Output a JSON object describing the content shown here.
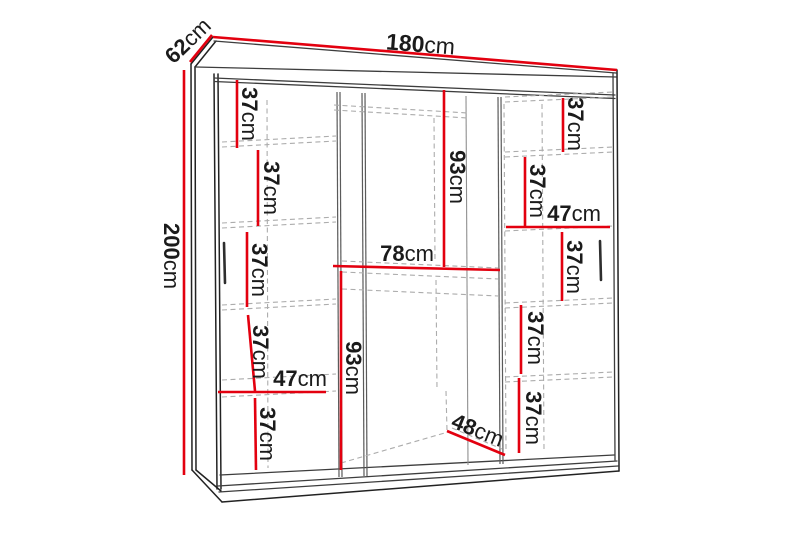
{
  "diagram": {
    "type": "furniture-dimension-drawing",
    "subject": "three-door sliding wardrobe wireframe with internal shelf measurements",
    "unit": "cm",
    "accent_color": "#e3000f",
    "line_color": "#1b1b1b",
    "hidden_line_color": "#acacac",
    "background": "#ffffff"
  },
  "overall": {
    "width": {
      "v": "180",
      "u": "cm"
    },
    "depth": {
      "v": "62",
      "u": "cm"
    },
    "height": {
      "v": "200",
      "u": "cm"
    }
  },
  "left_column": {
    "shelf1": {
      "v": "37",
      "u": "cm"
    },
    "shelf2": {
      "v": "37",
      "u": "cm"
    },
    "shelf3": {
      "v": "37",
      "u": "cm"
    },
    "shelf4": {
      "v": "37",
      "u": "cm"
    },
    "shelf5": {
      "v": "37",
      "u": "cm"
    },
    "width": {
      "v": "47",
      "u": "cm"
    }
  },
  "middle_column": {
    "upper_height": {
      "v": "93",
      "u": "cm"
    },
    "width": {
      "v": "78",
      "u": "cm"
    },
    "lower_height": {
      "v": "93",
      "u": "cm"
    },
    "floor_depth": {
      "v": "48",
      "u": "cm"
    }
  },
  "right_column": {
    "shelf1": {
      "v": "37",
      "u": "cm"
    },
    "shelf2": {
      "v": "37",
      "u": "cm"
    },
    "shelf3": {
      "v": "37",
      "u": "cm"
    },
    "shelf4": {
      "v": "37",
      "u": "cm"
    },
    "shelf5": {
      "v": "37",
      "u": "cm"
    },
    "width": {
      "v": "47",
      "u": "cm"
    }
  }
}
